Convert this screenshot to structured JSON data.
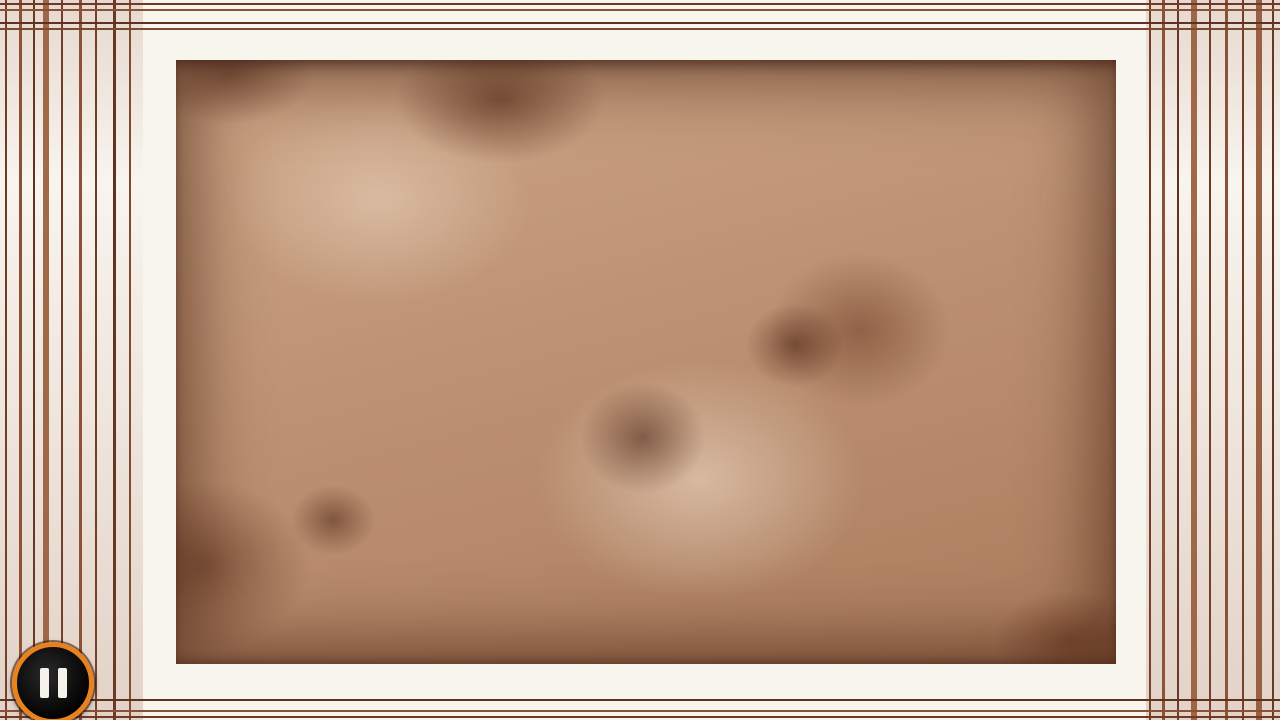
{
  "hud": {
    "pause_button": {
      "x": 48,
      "y": 678,
      "icon": "pause-icon",
      "ring_color": "#e8821e"
    }
  },
  "board": {
    "band": {
      "outer": [
        143,
        32,
        1147,
        697
      ],
      "field": [
        176,
        60,
        1116,
        664
      ]
    },
    "wall_thickness": 35,
    "colors": {
      "wall": "#f9f5ee",
      "wall_outline": "#2b1408",
      "wall_shadow": "rgba(70,30,10,0.3)",
      "joint": "#9a6848",
      "ladder": "#8a5a3e",
      "seam": "rgba(60,26,12,0.5)",
      "deco": "#8a5136",
      "hole_rim": "#c9ab90",
      "hole_dark": "#060302",
      "floor_mid": "#bd9273"
    },
    "deco_paths": [
      "M 186 46 H 1104 L 1131 73 V 650 L 1104 677 H 186 L 159 650 V 73 Z",
      "M 178 38 H 1112 L 1139 65 V 658 L 1112 685 H 178 L 151 658 V 65 Z",
      "M 196 66 H 1096 L 1110 80 V 644 L 1096 658 H 196 L 182 644 V 80 Z",
      "M 565 56 L 580 40 H 700 L 715 56",
      "M 965 56 L 980 40 H 1080 L 1095 56",
      "M 590 668 L 605 684 H 760 L 775 668"
    ],
    "corner_chamfers": [
      "176,60 208,60 176,92",
      "1116,60 1084,60 1116,92",
      "1116,664 1084,664 1116,632",
      "176,664 208,664 176,632"
    ]
  },
  "maze": {
    "walls": [
      {
        "id": "left-wall",
        "d": "M 333 44 V 490"
      },
      {
        "id": "arch-wall",
        "d": "M 478 676 V 300 A 157 157 0 0 1 792 300 V 302"
      },
      {
        "id": "hook-wall",
        "d": "M 957 44 V 438 A 151 151 0 1 1 655 425"
      }
    ],
    "tips": [
      "316,486 350,486 333,516",
      "776,298 808,298 792,328",
      "670,428 636,420 645,394"
    ],
    "joint_dash": "3 44",
    "micro_dash": "2 8",
    "ladders": [
      "M 333 92 V 138",
      "M 333 362 V 432",
      "M 478 390 V 465",
      "M 478 618 V 662",
      "M 529 196 L 573 163",
      "M 748 194 L 782 232",
      "M 957 60 V 96",
      "M 957 262 V 338",
      "M 668 498 L 700 540",
      "M 918 524 L 946 489"
    ],
    "connectors": [
      [
        318,
        50,
        30,
        24
      ],
      [
        942,
        50,
        30,
        24
      ],
      [
        463,
        644,
        30,
        24
      ],
      [
        390,
        36,
        26,
        24
      ],
      [
        782,
        36,
        26,
        24
      ],
      [
        386,
        664,
        26,
        24
      ],
      [
        864,
        664,
        26,
        24
      ],
      [
        146,
        202,
        26,
        26
      ],
      [
        146,
        424,
        26,
        26
      ],
      [
        1114,
        202,
        26,
        26
      ],
      [
        1114,
        430,
        26,
        26
      ]
    ],
    "seams": [
      "M 176 158 H 314",
      "M 352 160 H 826",
      "M 836 162 H 934",
      "M 982 162 H 1116",
      "M 830 60 V 158",
      "M 176 357 H 458",
      "M 630 358 H 934",
      "M 982 360 H 1116",
      "M 827 382 V 660",
      "M 718 358 V 418 L 758 452",
      "M 176 553 H 455",
      "M 240 553 L 278 515 H 460",
      "M 872 556 H 1116",
      "M 1067 480 V 554",
      "M 988 200 L 1032 163"
    ],
    "screws": [
      [
        290,
        508
      ],
      [
        667,
        339
      ],
      [
        726,
        470
      ],
      [
        547,
        133
      ],
      [
        1016,
        163
      ],
      [
        352,
        561
      ],
      [
        603,
        64
      ],
      [
        868,
        306
      ]
    ]
  },
  "holes": {
    "rim_radius": 33,
    "pit_radius": 25,
    "positions": [
      [
        472,
        154
      ],
      [
        795,
        97
      ],
      [
        610,
        214
      ],
      [
        866,
        248
      ],
      [
        1025,
        238
      ],
      [
        263,
        337
      ],
      [
        395,
        291
      ],
      [
        737,
        328
      ],
      [
        610,
        351
      ],
      [
        892,
        386
      ],
      [
        1073,
        363
      ],
      [
        417,
        433
      ],
      [
        207,
        487
      ],
      [
        545,
        543
      ],
      [
        770,
        497
      ],
      [
        667,
        587
      ],
      [
        1010,
        495
      ],
      [
        205,
        615
      ],
      [
        398,
        615
      ],
      [
        955,
        617
      ]
    ]
  },
  "pegs": {
    "bar_color": "#efe31f",
    "cap_color": "#8f8b80",
    "items": [
      {
        "x": 403,
        "y": 109,
        "angle": 90
      },
      {
        "x": 883,
        "y": 110,
        "angle": 35
      },
      {
        "x": 868,
        "y": 470,
        "angle": 3
      },
      {
        "x": 305,
        "y": 610,
        "angle": -15
      },
      {
        "x": 1053,
        "y": 608,
        "angle": -68
      }
    ]
  },
  "ball": {
    "x": 1047,
    "y": 116,
    "r": 21,
    "spiral_color": "#cf2a18",
    "spiral_d": "M 3 0 A 3 3 0 1 1 -3 0 A 4.5 4.5 0 1 1 6 0 A 7 7 0 1 1 -6.5 0 A 9 9 0 1 1 11 0 A 12 12 0 1 1 -13 0",
    "dots": [
      [
        -13,
        7
      ],
      [
        3,
        15
      ],
      [
        14,
        -7
      ],
      [
        -3,
        -14
      ]
    ]
  },
  "goal": {
    "x": 238,
    "y": 111,
    "r": 40,
    "ring_color": "#242b2e",
    "spoke_angles": [
      -18,
      54,
      126,
      198,
      270
    ],
    "dot_angles": [
      -65,
      30,
      150
    ],
    "bright": "#86f25f"
  },
  "frame": {
    "girders_top": [
      [
        250,
        44
      ],
      [
        545,
        44
      ],
      [
        725,
        44
      ],
      [
        1065,
        44
      ],
      [
        180,
        20
      ],
      [
        955,
        20
      ]
    ],
    "hatch_left": [
      [
        40,
        55,
        20,
        85
      ],
      [
        40,
        320,
        20,
        105
      ],
      [
        96,
        470,
        16,
        85
      ],
      [
        56,
        600,
        14,
        75
      ]
    ],
    "hatch_right": [
      [
        1158,
        85,
        16,
        85
      ],
      [
        1158,
        375,
        16,
        90
      ],
      [
        1242,
        250,
        16,
        85
      ],
      [
        1242,
        555,
        16,
        85
      ]
    ],
    "hatch_bottom": [
      [
        90,
        70
      ],
      [
        320,
        70
      ],
      [
        560,
        80
      ],
      [
        750,
        80
      ],
      [
        980,
        80
      ],
      [
        1140,
        60
      ]
    ]
  }
}
